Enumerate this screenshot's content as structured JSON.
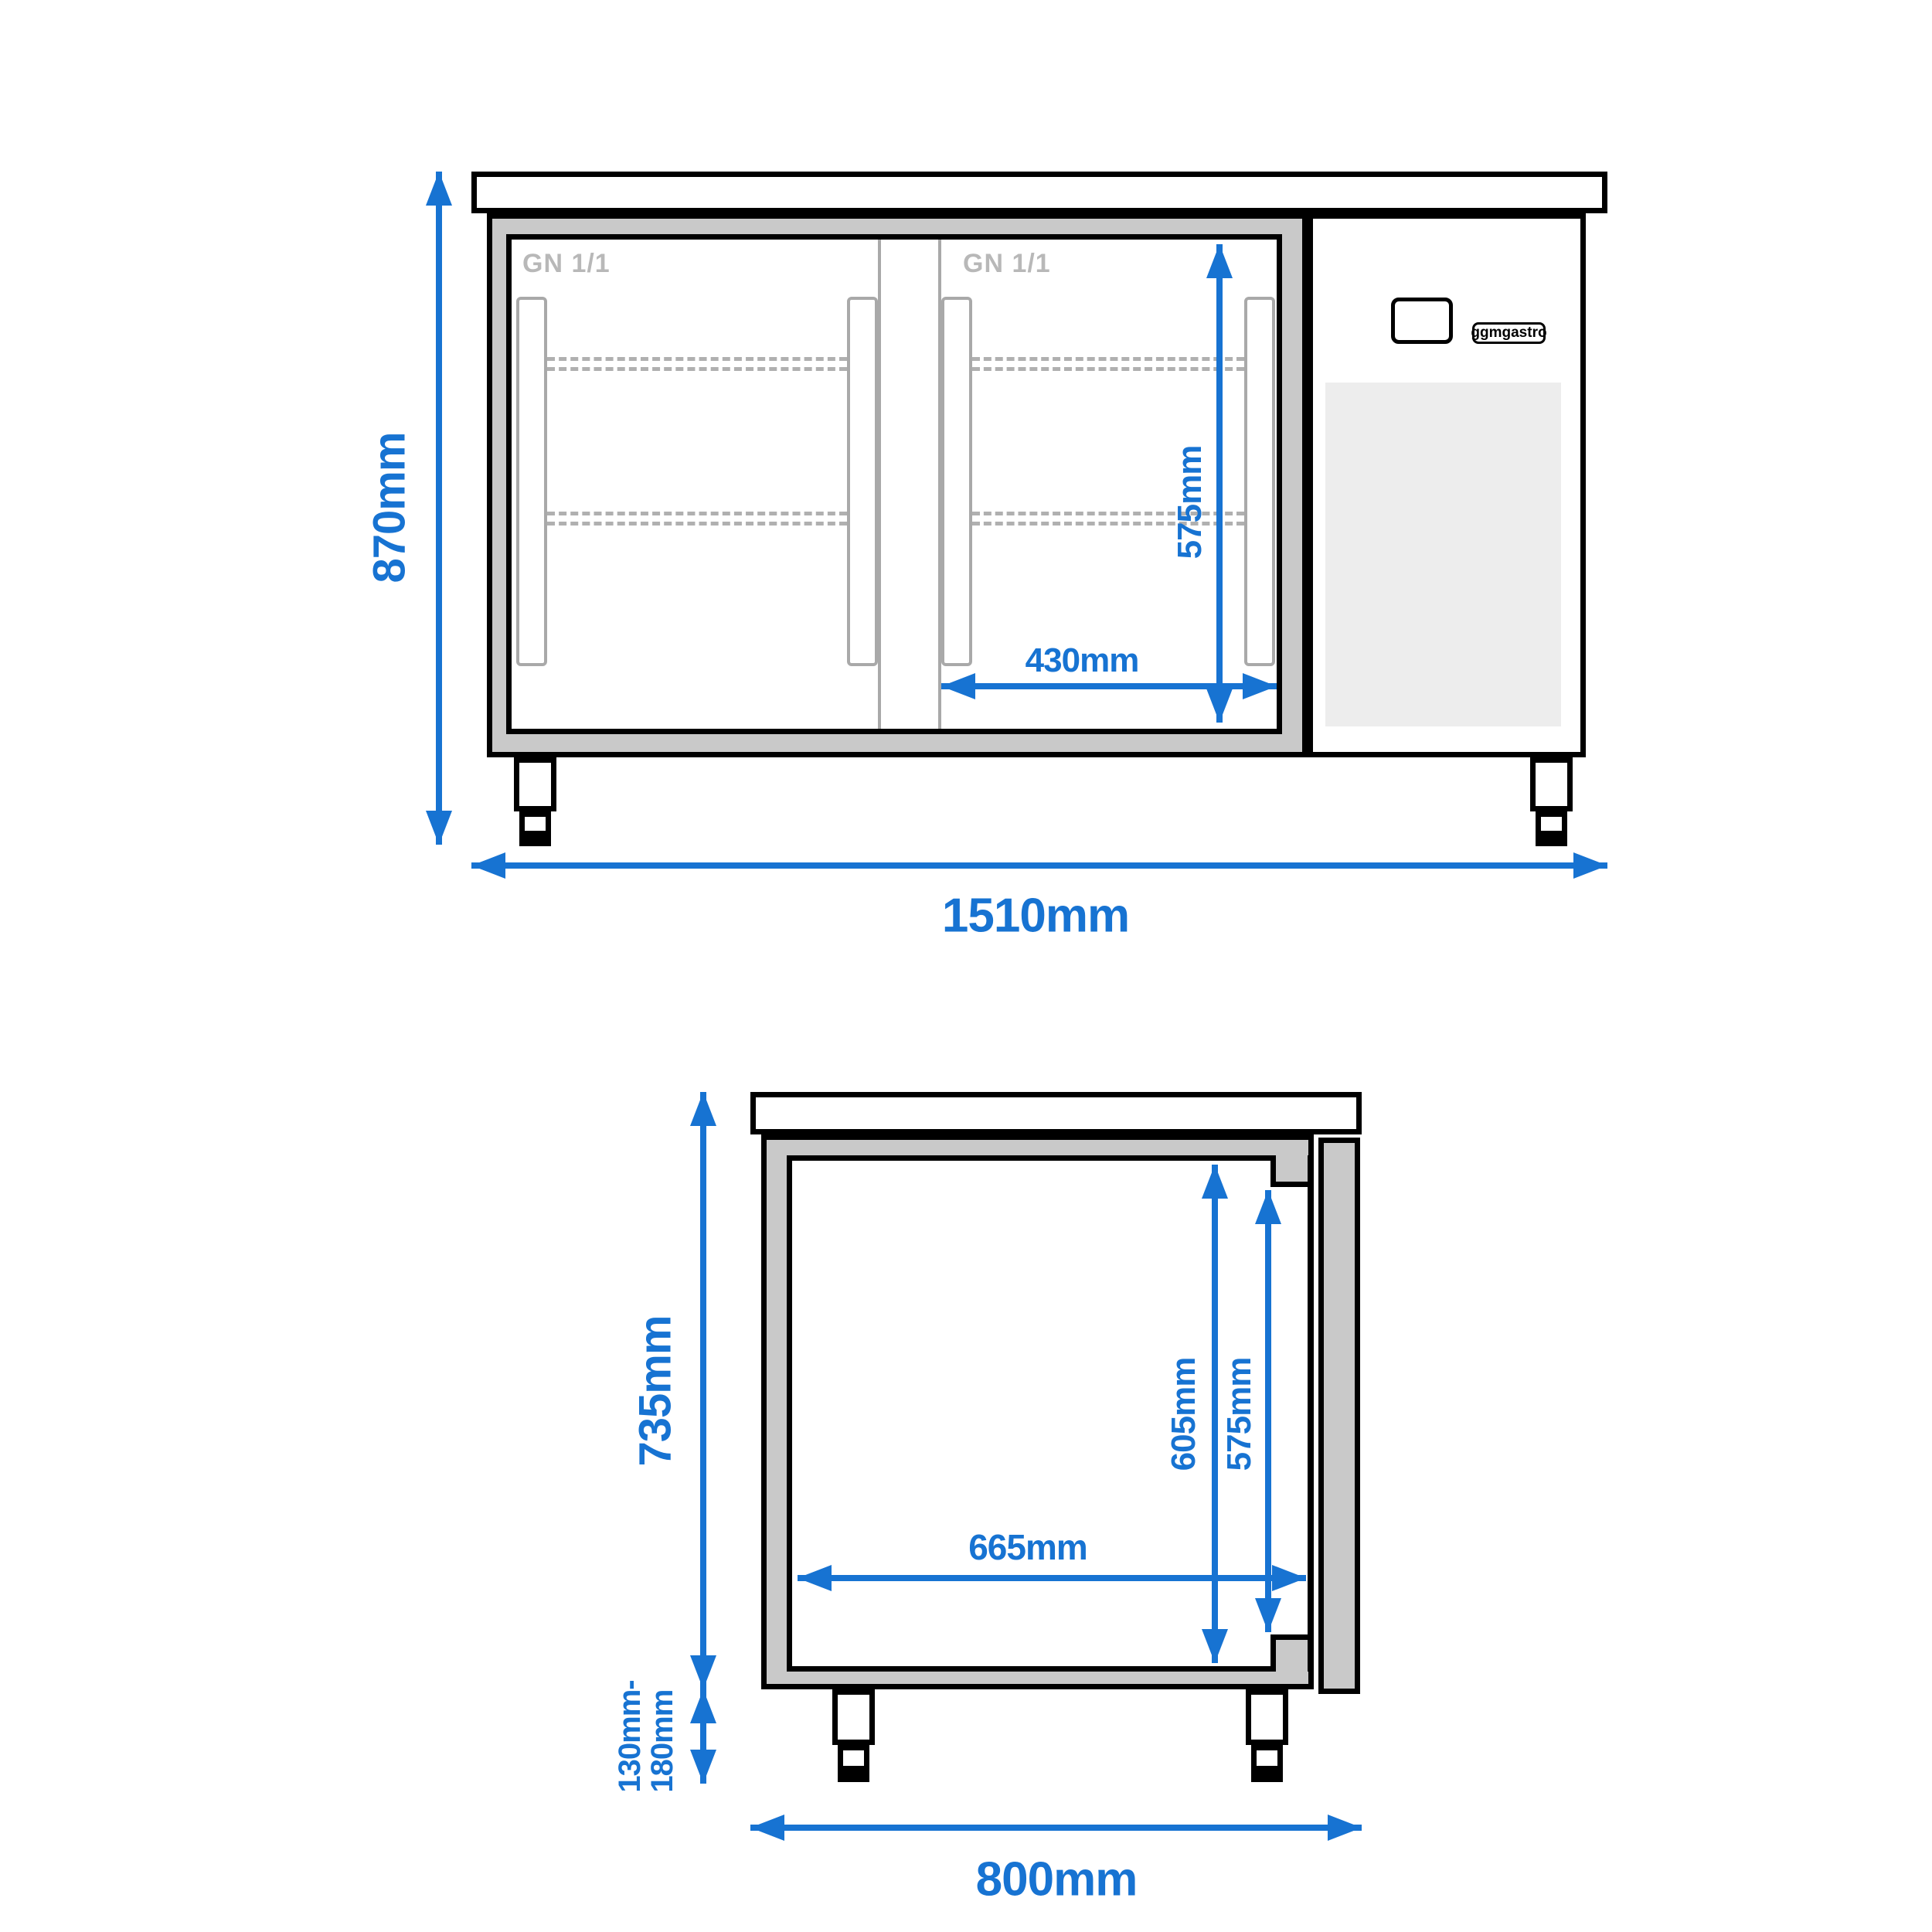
{
  "figure": {
    "front_view": {
      "labels": {
        "gn_left": "GN 1/1",
        "gn_right": "GN 1/1",
        "brand": "ggmgastro"
      },
      "dimensions": {
        "height": "870mm",
        "width": "1510mm",
        "door_inner_height": "575mm",
        "door_inner_width": "430mm"
      }
    },
    "side_view": {
      "dimensions": {
        "height": "735mm",
        "depth": "800mm",
        "inner_depth": "665mm",
        "inner_height": "605mm",
        "door_inner_height": "575mm",
        "leg_height_line1": "130mm-",
        "leg_height_line2": "180mm"
      }
    },
    "colors": {
      "dimension_blue": "#1773d2",
      "frame_gray": "#c9c9c9",
      "vent_gray": "#ededed",
      "detail_gray": "#a9a9a9",
      "label_gray": "#b8b8b8",
      "line_black": "#000000"
    }
  }
}
